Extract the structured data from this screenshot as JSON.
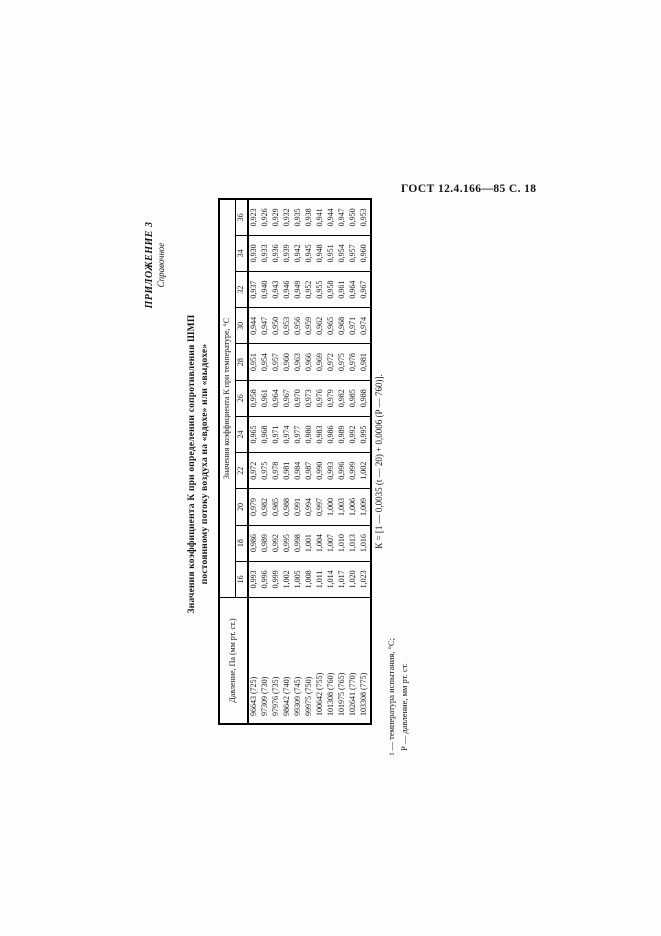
{
  "page_header": "ГОСТ 12.4.166—85 С. 18",
  "appendix": {
    "label": "ПРИЛОЖЕНИЕ 3",
    "sublabel": "Справочное"
  },
  "title": {
    "line1": "Значения коэффициента К при определении сопротивления ШМП",
    "line2": "постоянному потоку воздуха на «вдохе» или «выдохе»"
  },
  "table": {
    "pressure_header": "Давление, Па (мм рт. ст.)",
    "values_header": "Значения коэффициента К при температуре, °С",
    "temperatures": [
      "16",
      "18",
      "20",
      "22",
      "24",
      "26",
      "28",
      "30",
      "32",
      "34",
      "36"
    ],
    "rows": [
      {
        "pressure": "96643 (725)",
        "values": [
          "0,993",
          "0,986",
          "0,979",
          "0,972",
          "0,965",
          "0,958",
          "0,951",
          "0,944",
          "0,937",
          "0,930",
          "0,923"
        ]
      },
      {
        "pressure": "97309 (730)",
        "values": [
          "0,996",
          "0,989",
          "0,982",
          "0,975",
          "0,968",
          "0,961",
          "0,954",
          "0,947",
          "0,940",
          "0,933",
          "0,926"
        ]
      },
      {
        "pressure": "97976 (735)",
        "values": [
          "0,999",
          "0,992",
          "0,985",
          "0,978",
          "0,971",
          "0,964",
          "0,957",
          "0,950",
          "0,943",
          "0,936",
          "0,929"
        ]
      },
      {
        "pressure": "98642 (740)",
        "values": [
          "1,002",
          "0,995",
          "0,988",
          "0,981",
          "0,974",
          "0,967",
          "0,960",
          "0,953",
          "0,946",
          "0,939",
          "0,932"
        ]
      },
      {
        "pressure": "99309 (745)",
        "values": [
          "1,005",
          "0,998",
          "0,991",
          "0,984",
          "0,977",
          "0,970",
          "0,963",
          "0,956",
          "0,949",
          "0,942",
          "0,935"
        ]
      },
      {
        "pressure": "99975 (750)",
        "values": [
          "1,008",
          "1,001",
          "0,994",
          "0,987",
          "0,980",
          "0,973",
          "0,966",
          "0,959",
          "0,952",
          "0,945",
          "0,938"
        ]
      },
      {
        "pressure": "100642 (755)",
        "values": [
          "1,011",
          "1,004",
          "0,997",
          "0,990",
          "0,983",
          "0,976",
          "0,969",
          "0,962",
          "0,955",
          "0,948",
          "0,941"
        ]
      },
      {
        "pressure": "101308 (760)",
        "values": [
          "1,014",
          "1,007",
          "1,000",
          "0,993",
          "0,986",
          "0,979",
          "0,972",
          "0,965",
          "0,958",
          "0,951",
          "0,944"
        ]
      },
      {
        "pressure": "101975 (765)",
        "values": [
          "1,017",
          "1,010",
          "1,003",
          "0,996",
          "0,989",
          "0,982",
          "0,975",
          "0,968",
          "0,961",
          "0,954",
          "0,947"
        ]
      },
      {
        "pressure": "102641 (770)",
        "values": [
          "1,020",
          "1,013",
          "1,006",
          "0,999",
          "0,992",
          "0,985",
          "0,978",
          "0,971",
          "0,964",
          "0,957",
          "0,950"
        ]
      },
      {
        "pressure": "103308 (775)",
        "values": [
          "1,023",
          "1,016",
          "1,009",
          "1,002",
          "0,995",
          "0,988",
          "0,981",
          "0,974",
          "0,967",
          "0,960",
          "0,953"
        ]
      }
    ]
  },
  "formula": "К = [1 — 0,0035 (t — 20) + 0,0006 (Р — 760)].",
  "footnotes": [
    "t — температура испытания, °С;",
    "Р — давление, мм рт. ст."
  ]
}
